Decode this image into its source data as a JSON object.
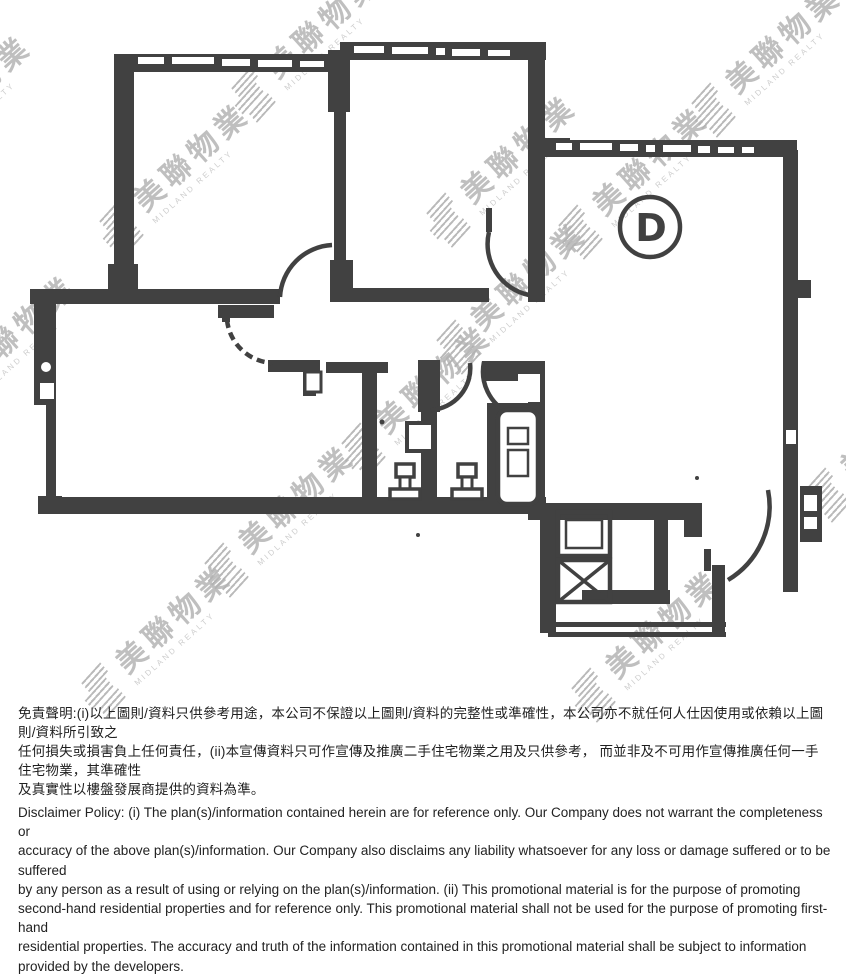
{
  "plan": {
    "room_label": "D"
  },
  "watermark": {
    "cjk": "美聯物業",
    "latin": "MIDLAND REALTY"
  },
  "disclaimer": {
    "zh_lines": [
      "免責聲明:(i)以上圖則/資料只供參考用途，本公司不保證以上圖則/資料的完整性或準確性，本公司亦不就任何人仕因使用或依賴以上圖則/資料所引致之",
      "任何損失或損害負上任何責任，(ii)本宣傳資料只可作宣傳及推廣二手住宅物業之用及只供參考， 而並非及不可用作宣傳推廣任何一手住宅物業，其準確性",
      "及真實性以樓盤發展商提供的資料為準。"
    ],
    "en_lines": [
      "Disclaimer Policy: (i) The plan(s)/information contained herein are for reference only. Our Company does not warrant the completeness or",
      "accuracy of the above plan(s)/information. Our Company also disclaims any liability whatsoever for any loss or damage suffered or to be suffered",
      "by any person as a result of using or relying on the plan(s)/information. (ii) This promotional material is for the purpose of promoting",
      "second-hand residential properties and for reference only. This promotional material shall not be used for the purpose of promoting first-hand",
      "residential properties. The accuracy and truth of the information contained in this promotional material shall be subject to information",
      "provided by the developers."
    ]
  },
  "colors": {
    "wall": "#414141",
    "watermark": "#b5b5b5",
    "text": "#1f1f1f"
  }
}
